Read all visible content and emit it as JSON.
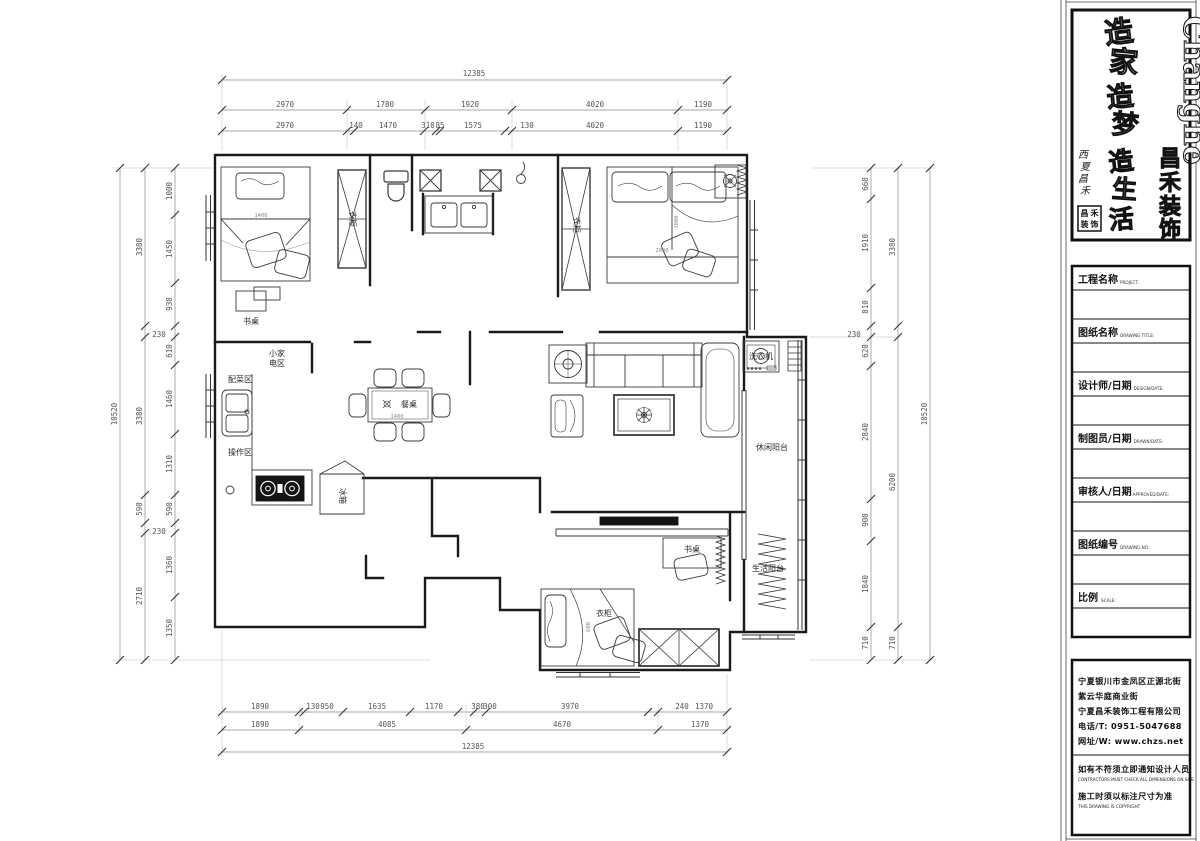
{
  "panel": {
    "brand": {
      "en": "Chanġhe",
      "cn": [
        "昌",
        "禾",
        "装",
        "饰"
      ],
      "slogan": [
        "造",
        "家",
        "造",
        "梦",
        "造",
        "生",
        "活"
      ],
      "side": [
        "西",
        "夏",
        "昌",
        "禾"
      ],
      "seal": [
        "昌",
        "禾",
        "装",
        "饰"
      ]
    },
    "title_block": {
      "rows": [
        {
          "label": "工程名称",
          "sub": "PROJECT:"
        },
        {
          "label": "图纸名称",
          "sub": "DRAWING TITLE:"
        },
        {
          "label": "设计师/日期",
          "sub": "DESIGN/DATE:"
        },
        {
          "label": "制图员/日期",
          "sub": "DRAWN/DATE:"
        },
        {
          "label": "审核人/日期",
          "sub": "APPROVED/DATE:"
        },
        {
          "label": "图纸编号",
          "sub": "DRAWING NO.:"
        },
        {
          "label": "比例",
          "sub": "SCALE:"
        }
      ]
    },
    "contact": {
      "line1": "宁夏银川市金凤区正源北街",
      "line2": "紫云华庭商业街",
      "line3": "宁夏昌禾装饰工程有限公司",
      "line4": "电话/T: 0951-5047688",
      "line5": "网址/W: www.chzs.net",
      "note1": "如有不符须立即通知设计人员",
      "note1_en": "CONTRACTORS MUST CHECK ALL DIMENSIONS ON SITE",
      "note2": "施工时须以标注尺寸为准",
      "note2_en": "THIS DRAWING IS COPYRIGHT"
    }
  },
  "dims": {
    "top": {
      "total": "12385",
      "row2": [
        "2970",
        "1780",
        "1920",
        "4020",
        "1190"
      ],
      "row3": [
        "2970",
        "140",
        "1470",
        "310",
        "85",
        "1575",
        "130",
        "4020",
        "1190"
      ]
    },
    "bottom": {
      "row1": [
        "1890",
        "130",
        "950",
        "1635",
        "1170",
        "380",
        "300",
        "3970",
        "240",
        "1370"
      ],
      "row2": [
        "1890",
        "4085",
        "4670",
        "1370"
      ],
      "total": "12385"
    },
    "left": {
      "total": "10520",
      "mid": [
        "3380",
        "3380",
        "590",
        "2710"
      ],
      "inner": [
        "1000",
        "1450",
        "930",
        "230",
        "610",
        "1460",
        "1310",
        "590",
        "230",
        "1360",
        "1350"
      ]
    },
    "right": {
      "total": "10520",
      "mid": [
        "3380",
        "6200",
        "710"
      ],
      "inner": [
        "660",
        "1910",
        "810",
        "230",
        "620",
        "2840",
        "900",
        "1840",
        "710"
      ]
    }
  },
  "plan": {
    "labels": {
      "desk": "书桌",
      "wardrobe": "衣柜",
      "appl1": "小家",
      "appl2": "电区",
      "prep": "配菜区",
      "work": "操作区",
      "table": "餐桌",
      "fridge": "冰箱",
      "washer": "洗衣机",
      "balcony1": "休闲阳台",
      "balcony2": "生活阳台",
      "d1400": "1400",
      "d2000": "2000",
      "d1800": "1800",
      "d600": "600"
    }
  }
}
